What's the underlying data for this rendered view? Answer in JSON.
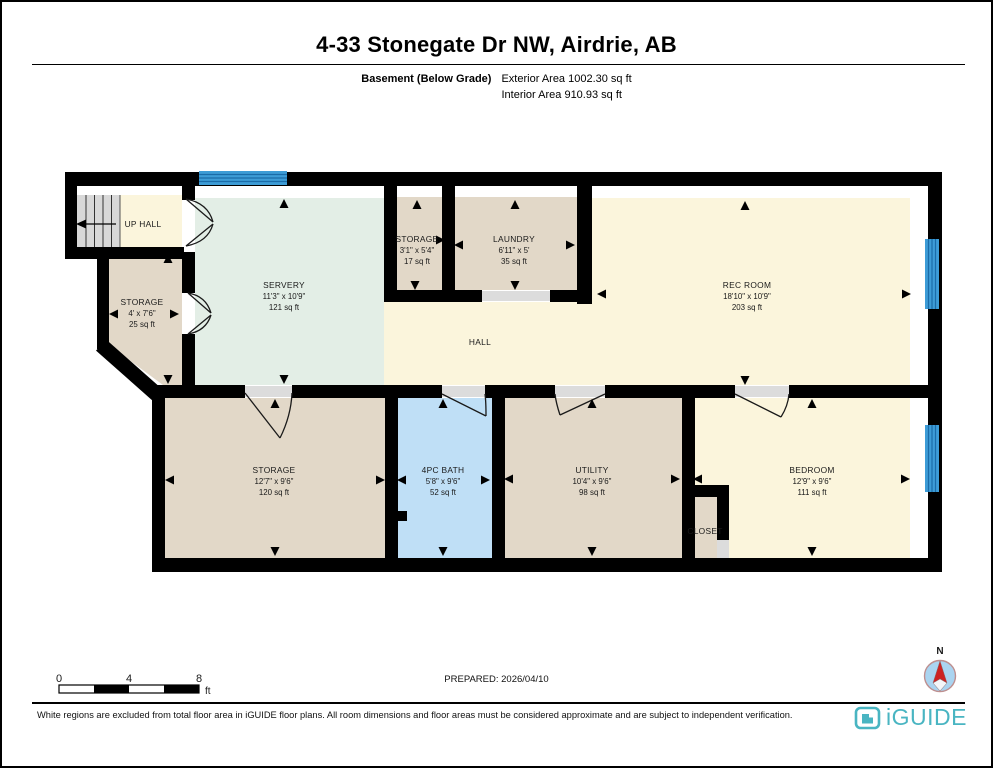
{
  "header": {
    "title": "4-33 Stonegate Dr NW, Airdrie, AB",
    "floor_label": "Basement (Below Grade)",
    "exterior_area": "Exterior Area 1002.30 sq ft",
    "interior_area": "Interior Area 910.93 sq ft"
  },
  "rooms": {
    "up_hall": {
      "name": "UP  HALL"
    },
    "storage_nw": {
      "name": "STORAGE",
      "dims": "4' x 7'6\"",
      "area": "25 sq ft"
    },
    "servery": {
      "name": "SERVERY",
      "dims": "11'3\" x 10'9\"",
      "area": "121 sq ft"
    },
    "storage_mid": {
      "name": "STORAGE",
      "dims": "3'1\" x 5'4\"",
      "area": "17 sq ft"
    },
    "laundry": {
      "name": "LAUNDRY",
      "dims": "6'11\" x 5'",
      "area": "35 sq ft"
    },
    "rec_room": {
      "name": "REC ROOM",
      "dims": "18'10\" x 10'9\"",
      "area": "203 sq ft"
    },
    "hall": {
      "name": "HALL"
    },
    "storage_sw": {
      "name": "STORAGE",
      "dims": "12'7\" x 9'6\"",
      "area": "120 sq ft"
    },
    "bath": {
      "name": "4PC BATH",
      "dims": "5'8\" x 9'6\"",
      "area": "52 sq ft"
    },
    "utility": {
      "name": "UTILITY",
      "dims": "10'4\" x 9'6\"",
      "area": "98 sq ft"
    },
    "closet": {
      "name": "CLOSET"
    },
    "bedroom": {
      "name": "BEDROOM",
      "dims": "12'9\" x 9'6\"",
      "area": "111 sq ft"
    }
  },
  "scale_bar": {
    "labels": [
      "0",
      "4",
      "8"
    ],
    "unit": "ft"
  },
  "compass": {
    "label": "N"
  },
  "footer": {
    "prepared": "PREPARED: 2026/04/10",
    "disclaimer": "White regions are excluded from total floor area in iGUIDE floor plans. All room dimensions and floor areas must be considered approximate and are subject to independent verification.",
    "brand": "iGUIDE"
  },
  "colors": {
    "wall": "#000000",
    "room_yellow": "#FBF5DC",
    "room_tan": "#E2D8C8",
    "room_mint": "#E3EEE6",
    "room_blue": "#BFDFF6",
    "window_blue": "#3D9CD6",
    "stairs_gray": "#D8D8D8",
    "door_opening_gray": "#DCDCDC",
    "brand_teal": "#49B5C2",
    "compass_red": "#CC2222"
  }
}
